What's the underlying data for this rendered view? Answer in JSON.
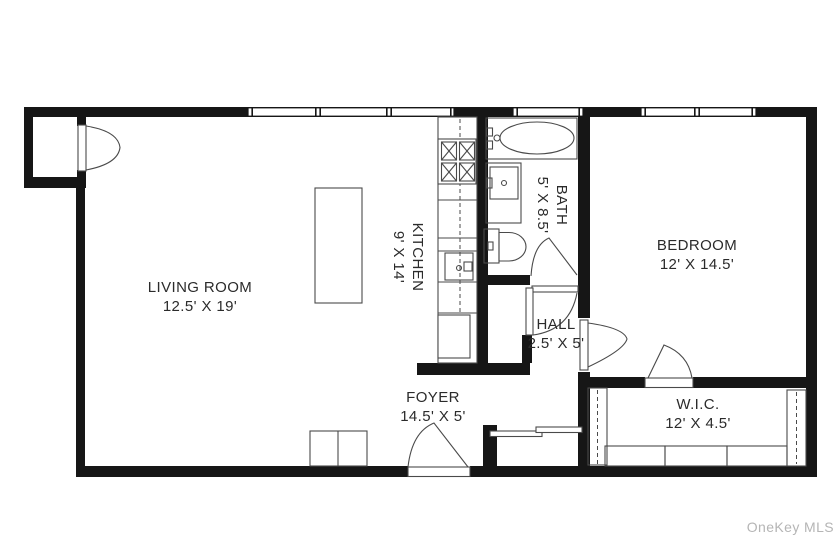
{
  "watermark": "OneKey MLS",
  "rooms": {
    "living_room": {
      "name": "LIVING ROOM",
      "dims": "12.5' X 19'"
    },
    "kitchen": {
      "name": "KITCHEN",
      "dims": "9' X 14'"
    },
    "bath": {
      "name": "BATH",
      "dims": "5' X 8.5'"
    },
    "bedroom": {
      "name": "BEDROOM",
      "dims": "12' X 14.5'"
    },
    "hall": {
      "name": "HALL",
      "dims": "2.5' X 5'"
    },
    "foyer": {
      "name": "FOYER",
      "dims": "14.5' X 5'"
    },
    "wic": {
      "name": "W.I.C.",
      "dims": "12' X 4.5'"
    }
  },
  "colors": {
    "wall": "#161616",
    "fixture": "#4a4a4a",
    "text": "#2b2b2b",
    "watermark": "#b5b5b5",
    "background": "#ffffff"
  }
}
